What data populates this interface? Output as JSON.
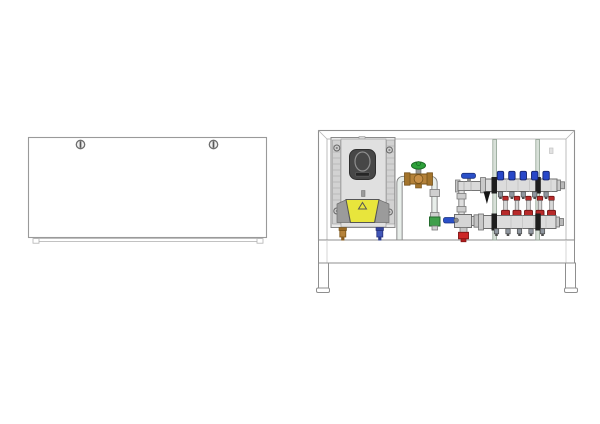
{
  "canvas": {
    "width": 600,
    "height": 424,
    "background": "#ffffff"
  },
  "views": {
    "closed": {
      "name": "manifold-cabinet-closed-front-view",
      "screw_count": 2
    },
    "open": {
      "name": "manifold-cabinet-open-front-view",
      "loops": 5,
      "risers": 2,
      "manifold_bars": 2
    }
  },
  "colors": {
    "outline": "#8f8f8f",
    "frame_inner": "#b5b5b5",
    "panel_gray": "#e9e9e9",
    "panel_mid": "#e0e0e0",
    "rib_gray": "#d2d2d2",
    "dark_badge": "#474747",
    "warning_yellow": "#e8e53c",
    "flank_gray": "#9b9b9b",
    "brass": "#b5823a",
    "brass_dark": "#74511a",
    "green_knob": "#2ea13a",
    "green_body": "#3f9f4a",
    "blue_handle": "#2a50c8",
    "blue_cap": "#2847c8",
    "red_meter": "#b82a2a",
    "red_drain": "#cc2626",
    "chrome": "#dcdcdc",
    "chrome_dark": "#c9c9c9",
    "pipe_fill": "#e8eeea",
    "pipe_edge": "#7e7e7e",
    "riser_fill": "#d7e0d8",
    "riser_edge": "#93a395",
    "black_part": "#1e1e1e",
    "dropper_navy": "#4156b8",
    "port_gray": "#9097a0"
  }
}
